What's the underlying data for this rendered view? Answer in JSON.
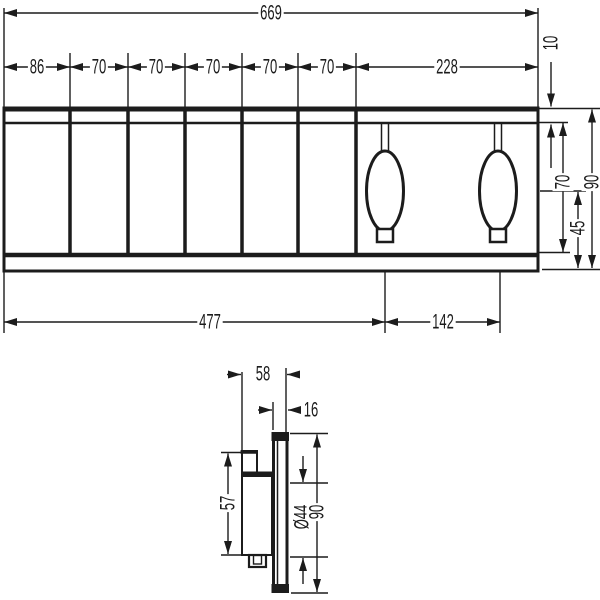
{
  "drawing": {
    "type": "technical-dimension-drawing",
    "colors": {
      "line": "#1c1c1c",
      "background": "#ffffff"
    },
    "front_view": {
      "overall_width": "669",
      "segments": [
        "86",
        "70",
        "70",
        "70",
        "70",
        "70",
        "228"
      ],
      "top_edge_offset": "10",
      "inner_height": "70",
      "total_height": "90",
      "center_to_bottom": "45",
      "left_to_first_knob": "477",
      "knob_spacing": "142"
    },
    "side_view": {
      "total_depth": "58",
      "plate_depth": "16",
      "block_height": "57",
      "knob_diameter": "Ø44",
      "plate_height": "90"
    }
  }
}
